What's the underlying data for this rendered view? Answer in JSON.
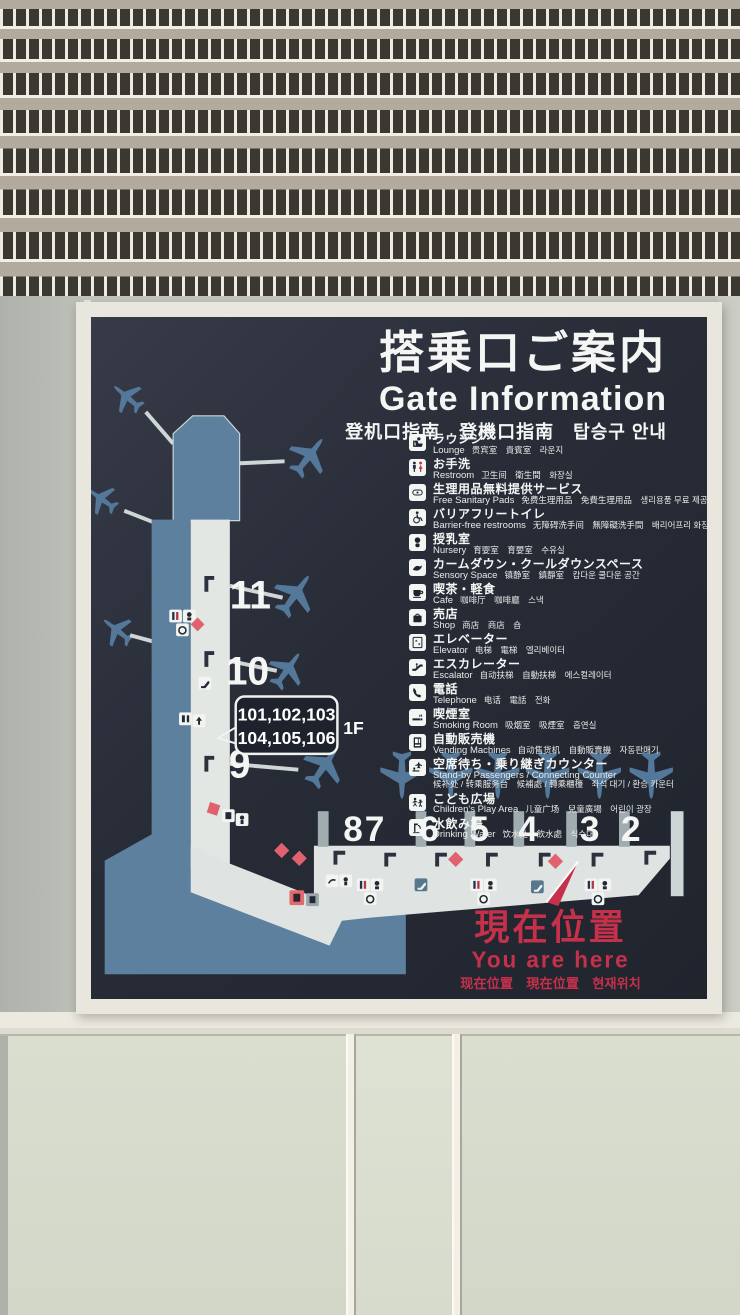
{
  "sign": {
    "title_ja": "搭乗口ご案内",
    "title_en": "Gate Information",
    "title_multi": "登机口指南　登機口指南　탑승구 안내"
  },
  "legend": [
    {
      "icon": "lounge-icon",
      "ja": "ラウンジ",
      "en": "Lounge",
      "multi": "贵宾室　貴賓室　라운지"
    },
    {
      "icon": "restroom-icon",
      "ja": "お手洗",
      "en": "Restroom",
      "multi": "卫生间　衛生間　화장실"
    },
    {
      "icon": "sanitary-pads-icon",
      "ja": "生理用品無料提供サービス",
      "en": "Free Sanitary Pads",
      "multi": "免费生理用品　免費生理用品　생리용품 무료 제공 서비스"
    },
    {
      "icon": "barrier-free-icon",
      "ja": "バリアフリートイレ",
      "en": "Barrier-free restrooms",
      "multi": "无障碍洗手间　無障礙洗手間　배리어프리 화장실"
    },
    {
      "icon": "nursery-icon",
      "ja": "授乳室",
      "en": "Nursery",
      "multi": "育婴室　育嬰室　수유실"
    },
    {
      "icon": "sensory-space-icon",
      "ja": "カームダウン・クールダウンスペース",
      "en": "Sensory Space",
      "multi": "镇静室　鎮靜室　캄다운 쿨다운 공간"
    },
    {
      "icon": "cafe-icon",
      "ja": "喫茶・軽食",
      "en": "Cafe",
      "multi": "咖啡厅　咖啡廳　스낵"
    },
    {
      "icon": "shop-icon",
      "ja": "売店",
      "en": "Shop",
      "multi": "商店　商店　숍"
    },
    {
      "icon": "elevator-icon",
      "ja": "エレベーター",
      "en": "Elevator",
      "multi": "电梯　電梯　엘리베이터"
    },
    {
      "icon": "escalator-icon",
      "ja": "エスカレーター",
      "en": "Escalator",
      "multi": "自动扶梯　自動扶梯　에스컬레이터"
    },
    {
      "icon": "telephone-icon",
      "ja": "電話",
      "en": "Telephone",
      "multi": "电话　電話　전화"
    },
    {
      "icon": "smoking-room-icon",
      "ja": "喫煙室",
      "en": "Smoking Room",
      "multi": "吸烟室　吸煙室　흡연실"
    },
    {
      "icon": "vending-machines-icon",
      "ja": "自動販売機",
      "en": "Vending Machines",
      "multi": "自动售货机　自動販賣機　자동판매기"
    },
    {
      "icon": "standby-counter-icon",
      "ja": "空席待ち・乗り継ぎカウンター",
      "en": "Stand-by Passengers / Connecting Counter",
      "multi": "候补处 / 转乘服务台　候補處 / 轉乘櫃檯　좌석 대기 / 환승 카운터"
    },
    {
      "icon": "children-play-area-icon",
      "ja": "こども広場",
      "en": "Children's Play Area",
      "multi": "儿童广场　兒童廣場　어린이 광장"
    },
    {
      "icon": "drinking-water-icon",
      "ja": "水飲み場",
      "en": "Drinking Water",
      "multi": "饮水处　飲水處　식수대"
    }
  ],
  "map": {
    "gates_vertical": [
      "11",
      "10",
      "9"
    ],
    "gates_horizontal": [
      "8",
      "7",
      "6",
      "5",
      "4",
      "3",
      "2"
    ],
    "callout": {
      "line1": "101,102,103",
      "line2": "104,105,106",
      "floor": "1F"
    },
    "you_are_here": {
      "ja": "現在位置",
      "en": "You are here",
      "multi": "现在位置　現在位置　현재위치"
    }
  },
  "colors": {
    "panel_background": "#2a2e39",
    "steel_blue": "#5d809e",
    "pier_light": "#e3e7e4",
    "accent_red": "#c5304a",
    "diamond_pink": "#e0626e"
  }
}
